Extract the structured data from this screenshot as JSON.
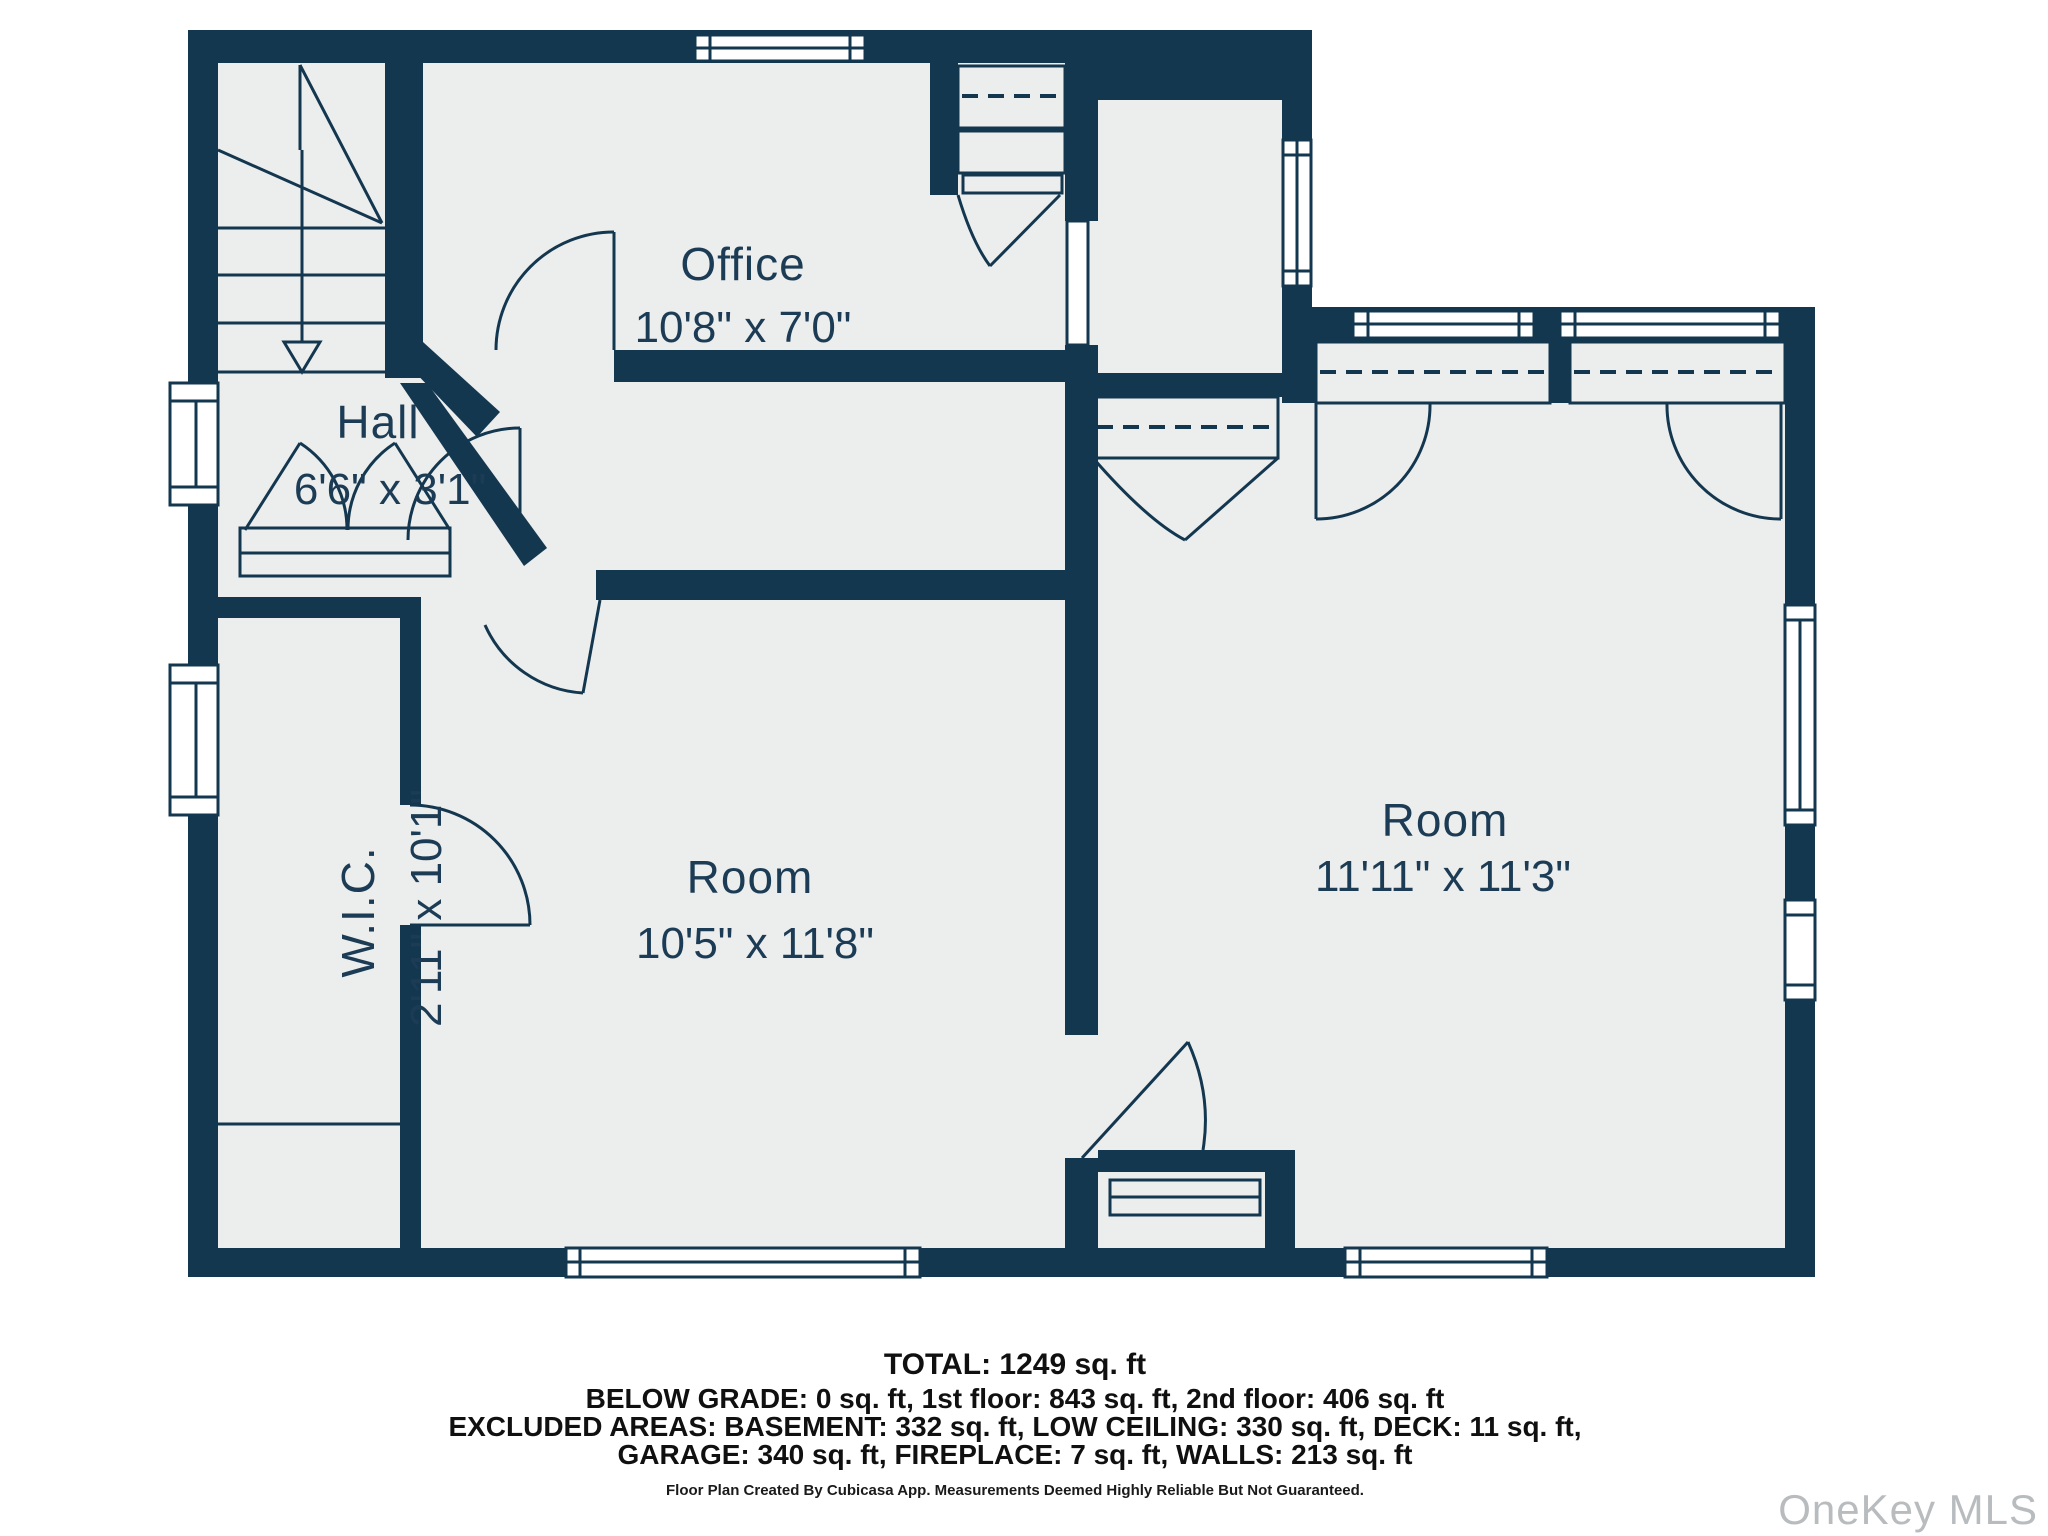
{
  "floor_plan": {
    "rooms": [
      {
        "name": "Office",
        "dimensions": "10'8\" x 7'0\""
      },
      {
        "name": "Hall",
        "dimensions": "6'6\" x 3'1\""
      },
      {
        "name": "W.I.C.",
        "dimensions": "2'11\" x 10'1\""
      },
      {
        "name": "Room",
        "dimensions": "10'5\" x 11'8\""
      },
      {
        "name": "Room",
        "dimensions": "11'11\" x 11'3\""
      }
    ],
    "colors": {
      "wall": "#143750",
      "room_fill": "#ECEDED",
      "label_text": "#1C3C55"
    }
  },
  "summary": {
    "total": "TOTAL: 1249 sq. ft",
    "line1": "BELOW GRADE: 0 sq. ft, 1st floor: 843 sq. ft, 2nd floor: 406 sq. ft",
    "line2": "EXCLUDED AREAS: BASEMENT: 332 sq. ft, LOW CEILING: 330 sq. ft, DECK: 11 sq. ft,",
    "line3": "GARAGE: 340 sq. ft, FIREPLACE: 7 sq. ft, WALLS: 213 sq. ft",
    "disclaimer": "Floor Plan Created By Cubicasa App. Measurements Deemed Highly Reliable But Not Guaranteed."
  },
  "watermark": "OneKey MLS"
}
